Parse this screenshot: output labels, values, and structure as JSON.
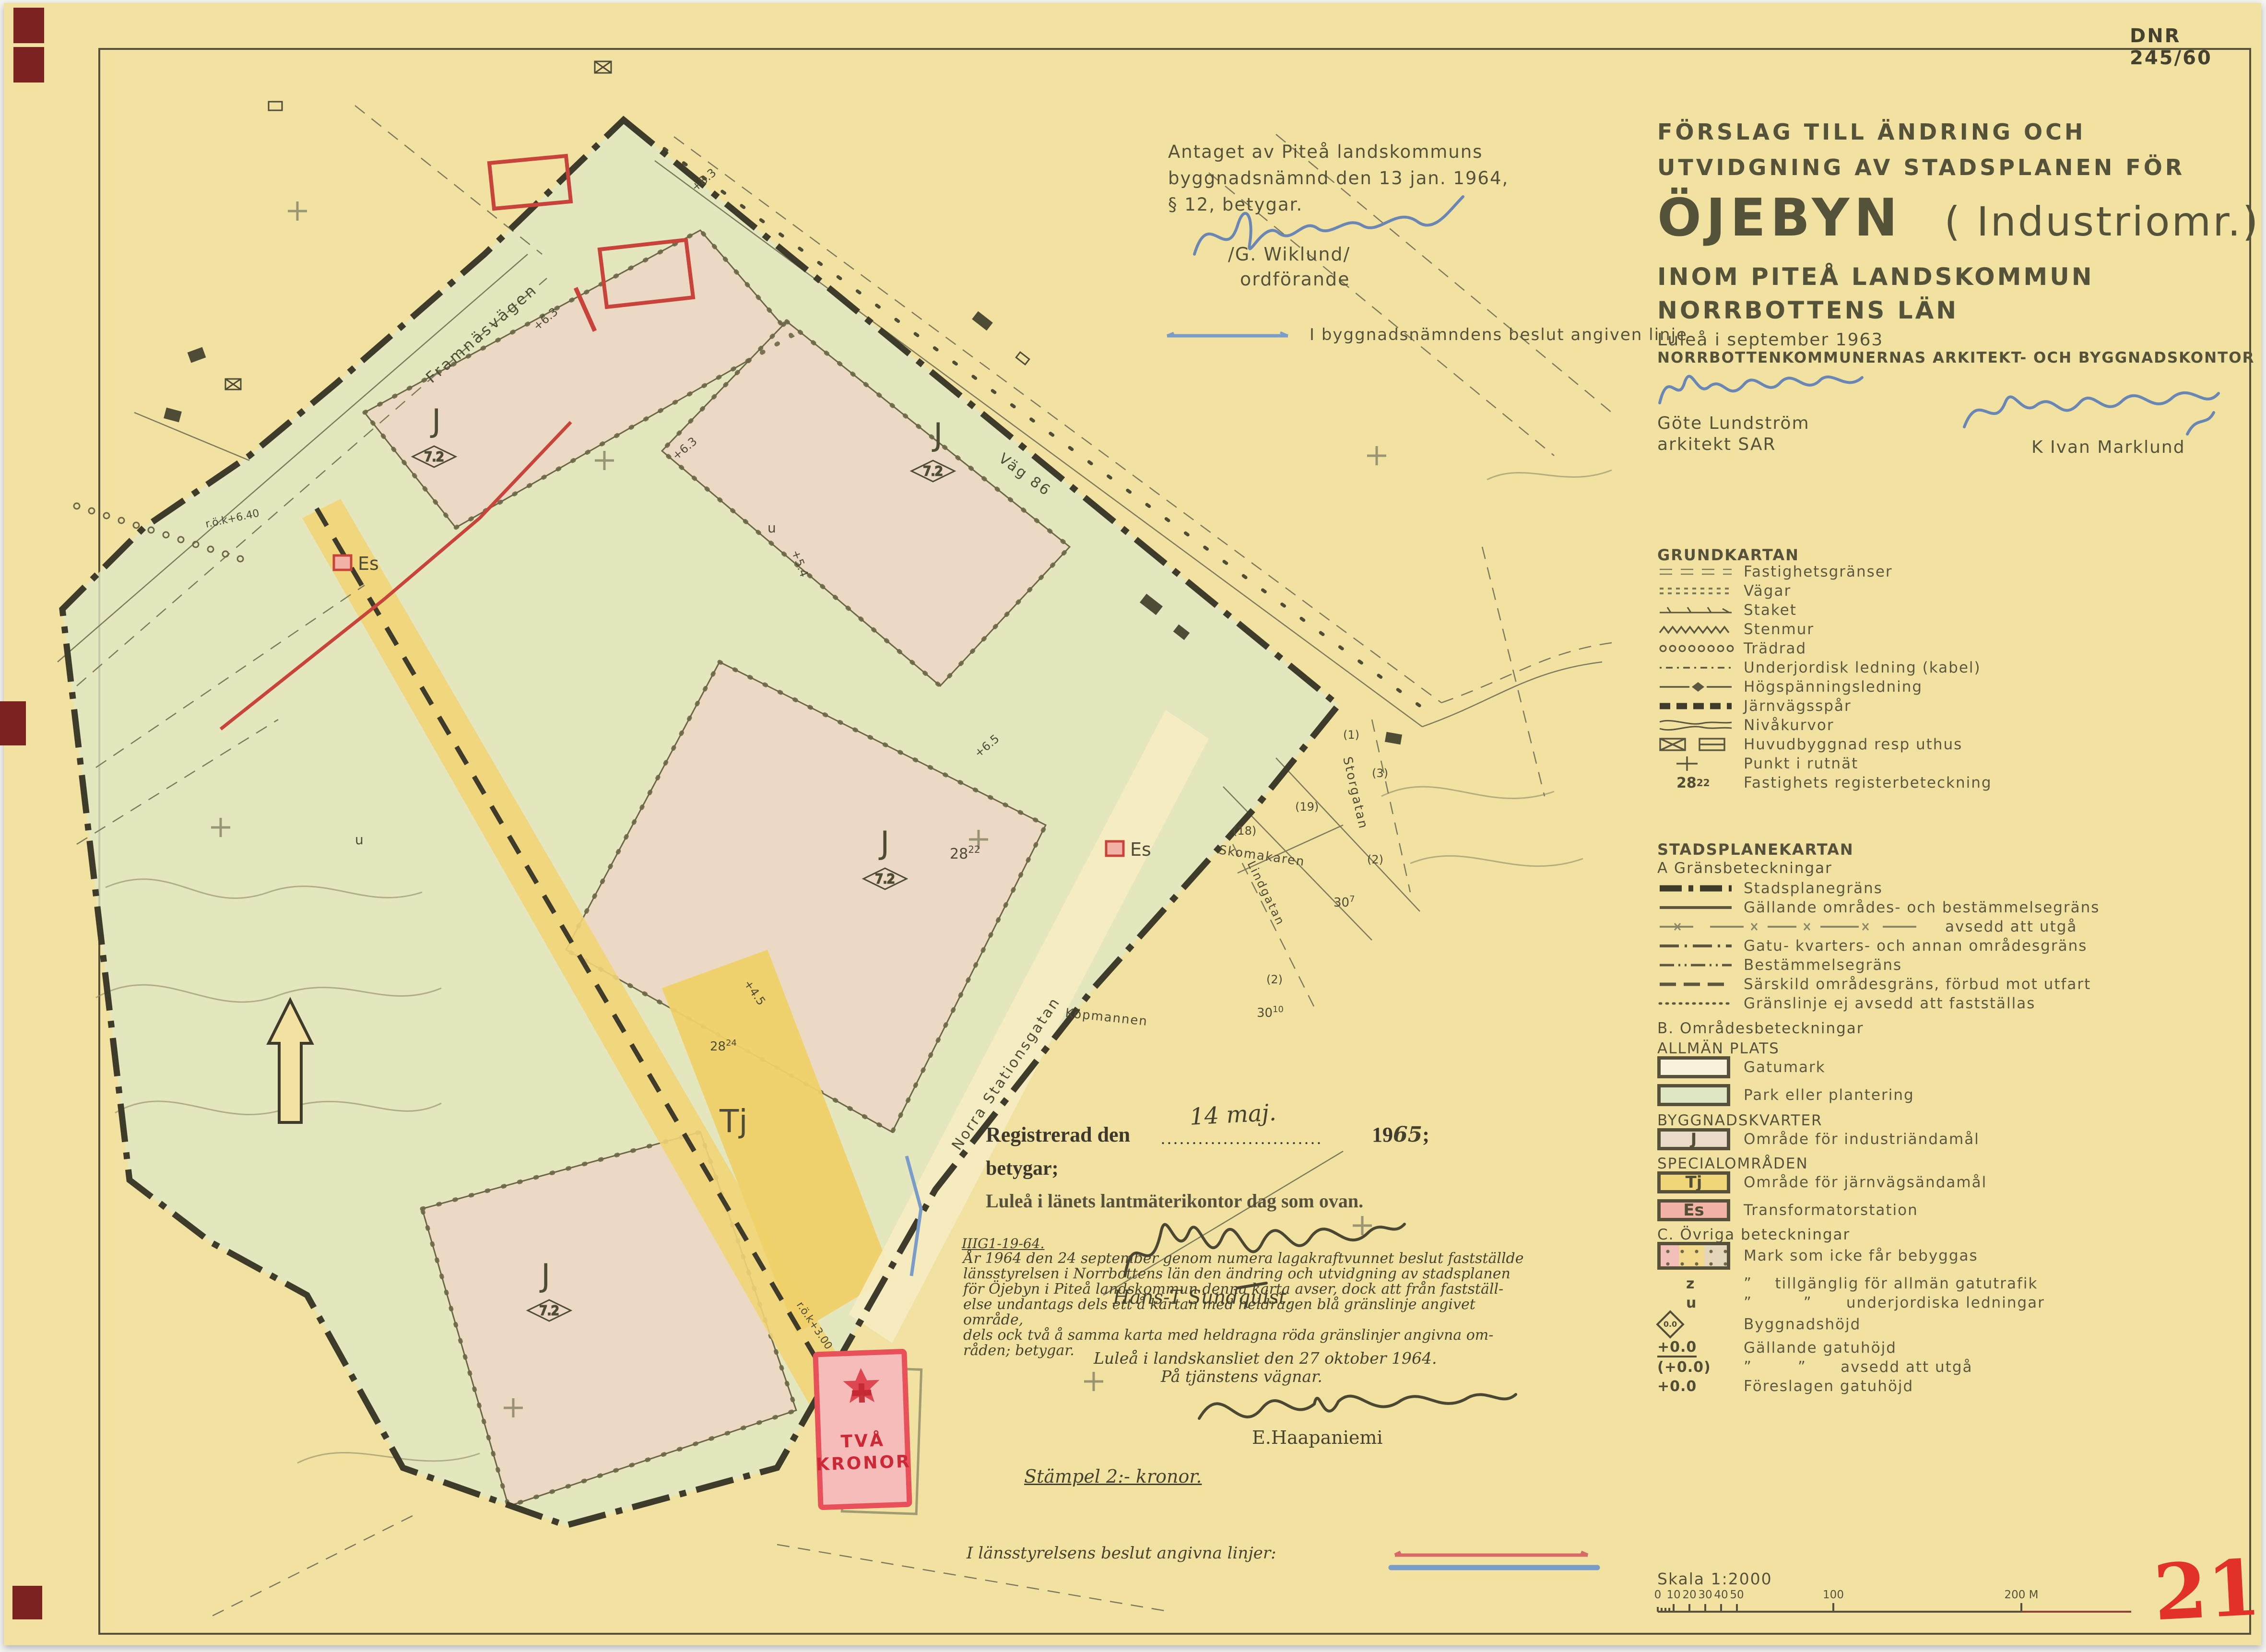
{
  "doc": {
    "dnr": "DNR 245/60",
    "sheet_number": "211",
    "ref_number": "IIIG1-19-64."
  },
  "title_block": {
    "line1": "FÖRSLAG TILL ÄNDRING OCH",
    "line2": "UTVIDGNING AV STADSPLANEN FÖR",
    "name": "ÖJEBYN",
    "name_suffix": "( Industriomr.)",
    "line3": "INOM PITEÅ LANDSKOMMUN",
    "line4": "NORRBOTTENS LÄN",
    "place_date": "Luleå i september 1963",
    "office": "NORRBOTTENKOMMUNERNAS ARKITEKT- OCH BYGGNADSKONTOR",
    "architect_name": "Göte Lundström",
    "architect_title": "arkitekt SAR",
    "cosigner": "K Ivan Marklund"
  },
  "adoption": {
    "line1": "Antaget av Piteå landskommuns",
    "line2": "byggnadsnämnd den 13 jan. 1964,",
    "line3": "§ 12, betygar.",
    "signature_name": "/G. Wiklund/",
    "signer_role": "ordförande"
  },
  "bn_line": {
    "label": "I byggnadsnämndens beslut angiven linje",
    "color": "#7a9cc8"
  },
  "registration": {
    "prefix": "Registrerad den",
    "date_hand": "14 maj.",
    "year_print": "19",
    "year_hand": "65",
    "tail": ";",
    "line2": "betygar;",
    "line3": "Luleå i länets lantmäterikontor dag som ovan.",
    "signer": "Hans-T Sundquist."
  },
  "decision": {
    "lines": [
      "År 1964 den 24 september genom numera lagakraftvunnet beslut fastställde",
      "länsstyrelsen i Norrbottens län den ändring och utvidgning av stadsplanen",
      "för Öjebyn i Piteå landskommun denna karta avser, dock att från fastställ-",
      "else undantags dels ett å kartan med heldragen blå gränslinje angivet område,",
      "dels ock två å samma karta med heldragna röda gränslinjer angivna om-",
      "råden; betygar."
    ],
    "place_line": "Luleå i landskansliet den 27 oktober 1964.",
    "behalf_line": "På tjänstens vägnar.",
    "signer": "E.Haapaniemi"
  },
  "stamp": {
    "word1": "TVÅ",
    "word2": "KRONOR",
    "note": "Stämpel 2:- kronor."
  },
  "ls_lines": {
    "label": "I länsstyrelsens beslut angivna linjer:",
    "red": "#c8443a",
    "blue": "#7a9cc8"
  },
  "legend_grund": {
    "title": "GRUNDKARTAN",
    "items": [
      "Fastighetsgränser",
      "Vägar",
      "Staket",
      "Stenmur",
      "Trädrad",
      "Underjordisk ledning (kabel)",
      "Högspänningsledning",
      "Järnvägsspår",
      "Nivåkurvor",
      "Huvudbyggnad resp uthus",
      "Punkt i rutnät",
      "Fastighets registerbeteckning"
    ],
    "reg_base": "28",
    "reg_sup": "22"
  },
  "legend_plan": {
    "title": "STADSPLANEKARTAN",
    "a_heading": "A Gränsbeteckningar",
    "a_items": [
      "Stadsplanegräns",
      "Gällande områdes- och bestämmelsegräns",
      "avsedd att utgå",
      "Gatu- kvarters- och annan områdesgräns",
      "Bestämmelsegräns",
      "Särskild områdesgräns, förbud mot utfart",
      "Gränslinje ej avsedd att fastställas"
    ],
    "b_heading": "B. Områdesbeteckningar",
    "allman_heading": "ALLMÄN PLATS",
    "allman_items": [
      "Gatumark",
      "Park eller plantering"
    ],
    "bygg_heading": "BYGGNADSKVARTER",
    "j_sym": "J",
    "j_label": "Område för industriändamål",
    "special_heading": "SPECIALOMRÅDEN",
    "tj_sym": "Tj",
    "tj_label": "Område för järnvägsändamål",
    "es_sym": "Es",
    "es_label": "Transformatorstation",
    "c_heading": "C. Övriga beteckningar",
    "c_items": [
      {
        "sym": "",
        "label": "Mark som icke får bebyggas"
      },
      {
        "sym": "z",
        "label": "”    tillgänglig för allmän gatutrafik"
      },
      {
        "sym": "u",
        "label": "”         ”      underjordiska ledningar"
      },
      {
        "sym": "0.0",
        "label": "Byggnadshöjd"
      },
      {
        "sym": "+0.0",
        "label": "Gällande gatuhöjd"
      },
      {
        "sym": "(+0.0)",
        "label": "”        ”      avsedd att utgå"
      },
      {
        "sym": "+0.0",
        "label": "Föreslagen gatuhöjd"
      }
    ]
  },
  "scale": {
    "label": "Skala 1:2000",
    "minor_ticks": [
      "0",
      "10",
      "20",
      "30",
      "40",
      "50"
    ],
    "mid_tick": "100",
    "end_tick": "200 M"
  },
  "map": {
    "streets": {
      "framnasvagen": "Framnäsvägen",
      "vag_86": "Väg 86",
      "norra_stationsgatan": "Norra Stationsgatan",
      "storgatan": "Storgatan",
      "lindgatan": "Lindgatan"
    },
    "blocks": {
      "skomakaren": "Skomakaren",
      "kopmannen": "Köpmannen"
    },
    "district_j": "J",
    "district_tj": "Tj",
    "district_es": "Es",
    "use_value": "7.2",
    "reg": {
      "r1b": "28",
      "r1s": "22",
      "r2b": "28",
      "r2s": "24",
      "r3b": "30",
      "r3s": "7",
      "r4b": "30",
      "r4s": "10"
    },
    "parcels": [
      "(18)",
      "(19)",
      "(2)",
      "(2)",
      "(1)",
      "(3)"
    ],
    "heights": [
      "+8.3",
      "+6.3",
      "+6.3",
      "+6.5",
      "+5.4",
      "+4.5"
    ],
    "rok1": "r.ö.k+6.40",
    "rok2": "r.ö.k+3.00",
    "u": "u"
  },
  "colors": {
    "paper": "#f2e2a2",
    "ink": "#4f4c36",
    "park_green": "#e0e7c5",
    "block_pink": "#ecd9c3",
    "rail_yellow": "#f1d475",
    "es_pink": "#f2b3a6",
    "red": "#c8443a",
    "blue": "#7a9cc8",
    "stamp_red": "#e8505a"
  }
}
